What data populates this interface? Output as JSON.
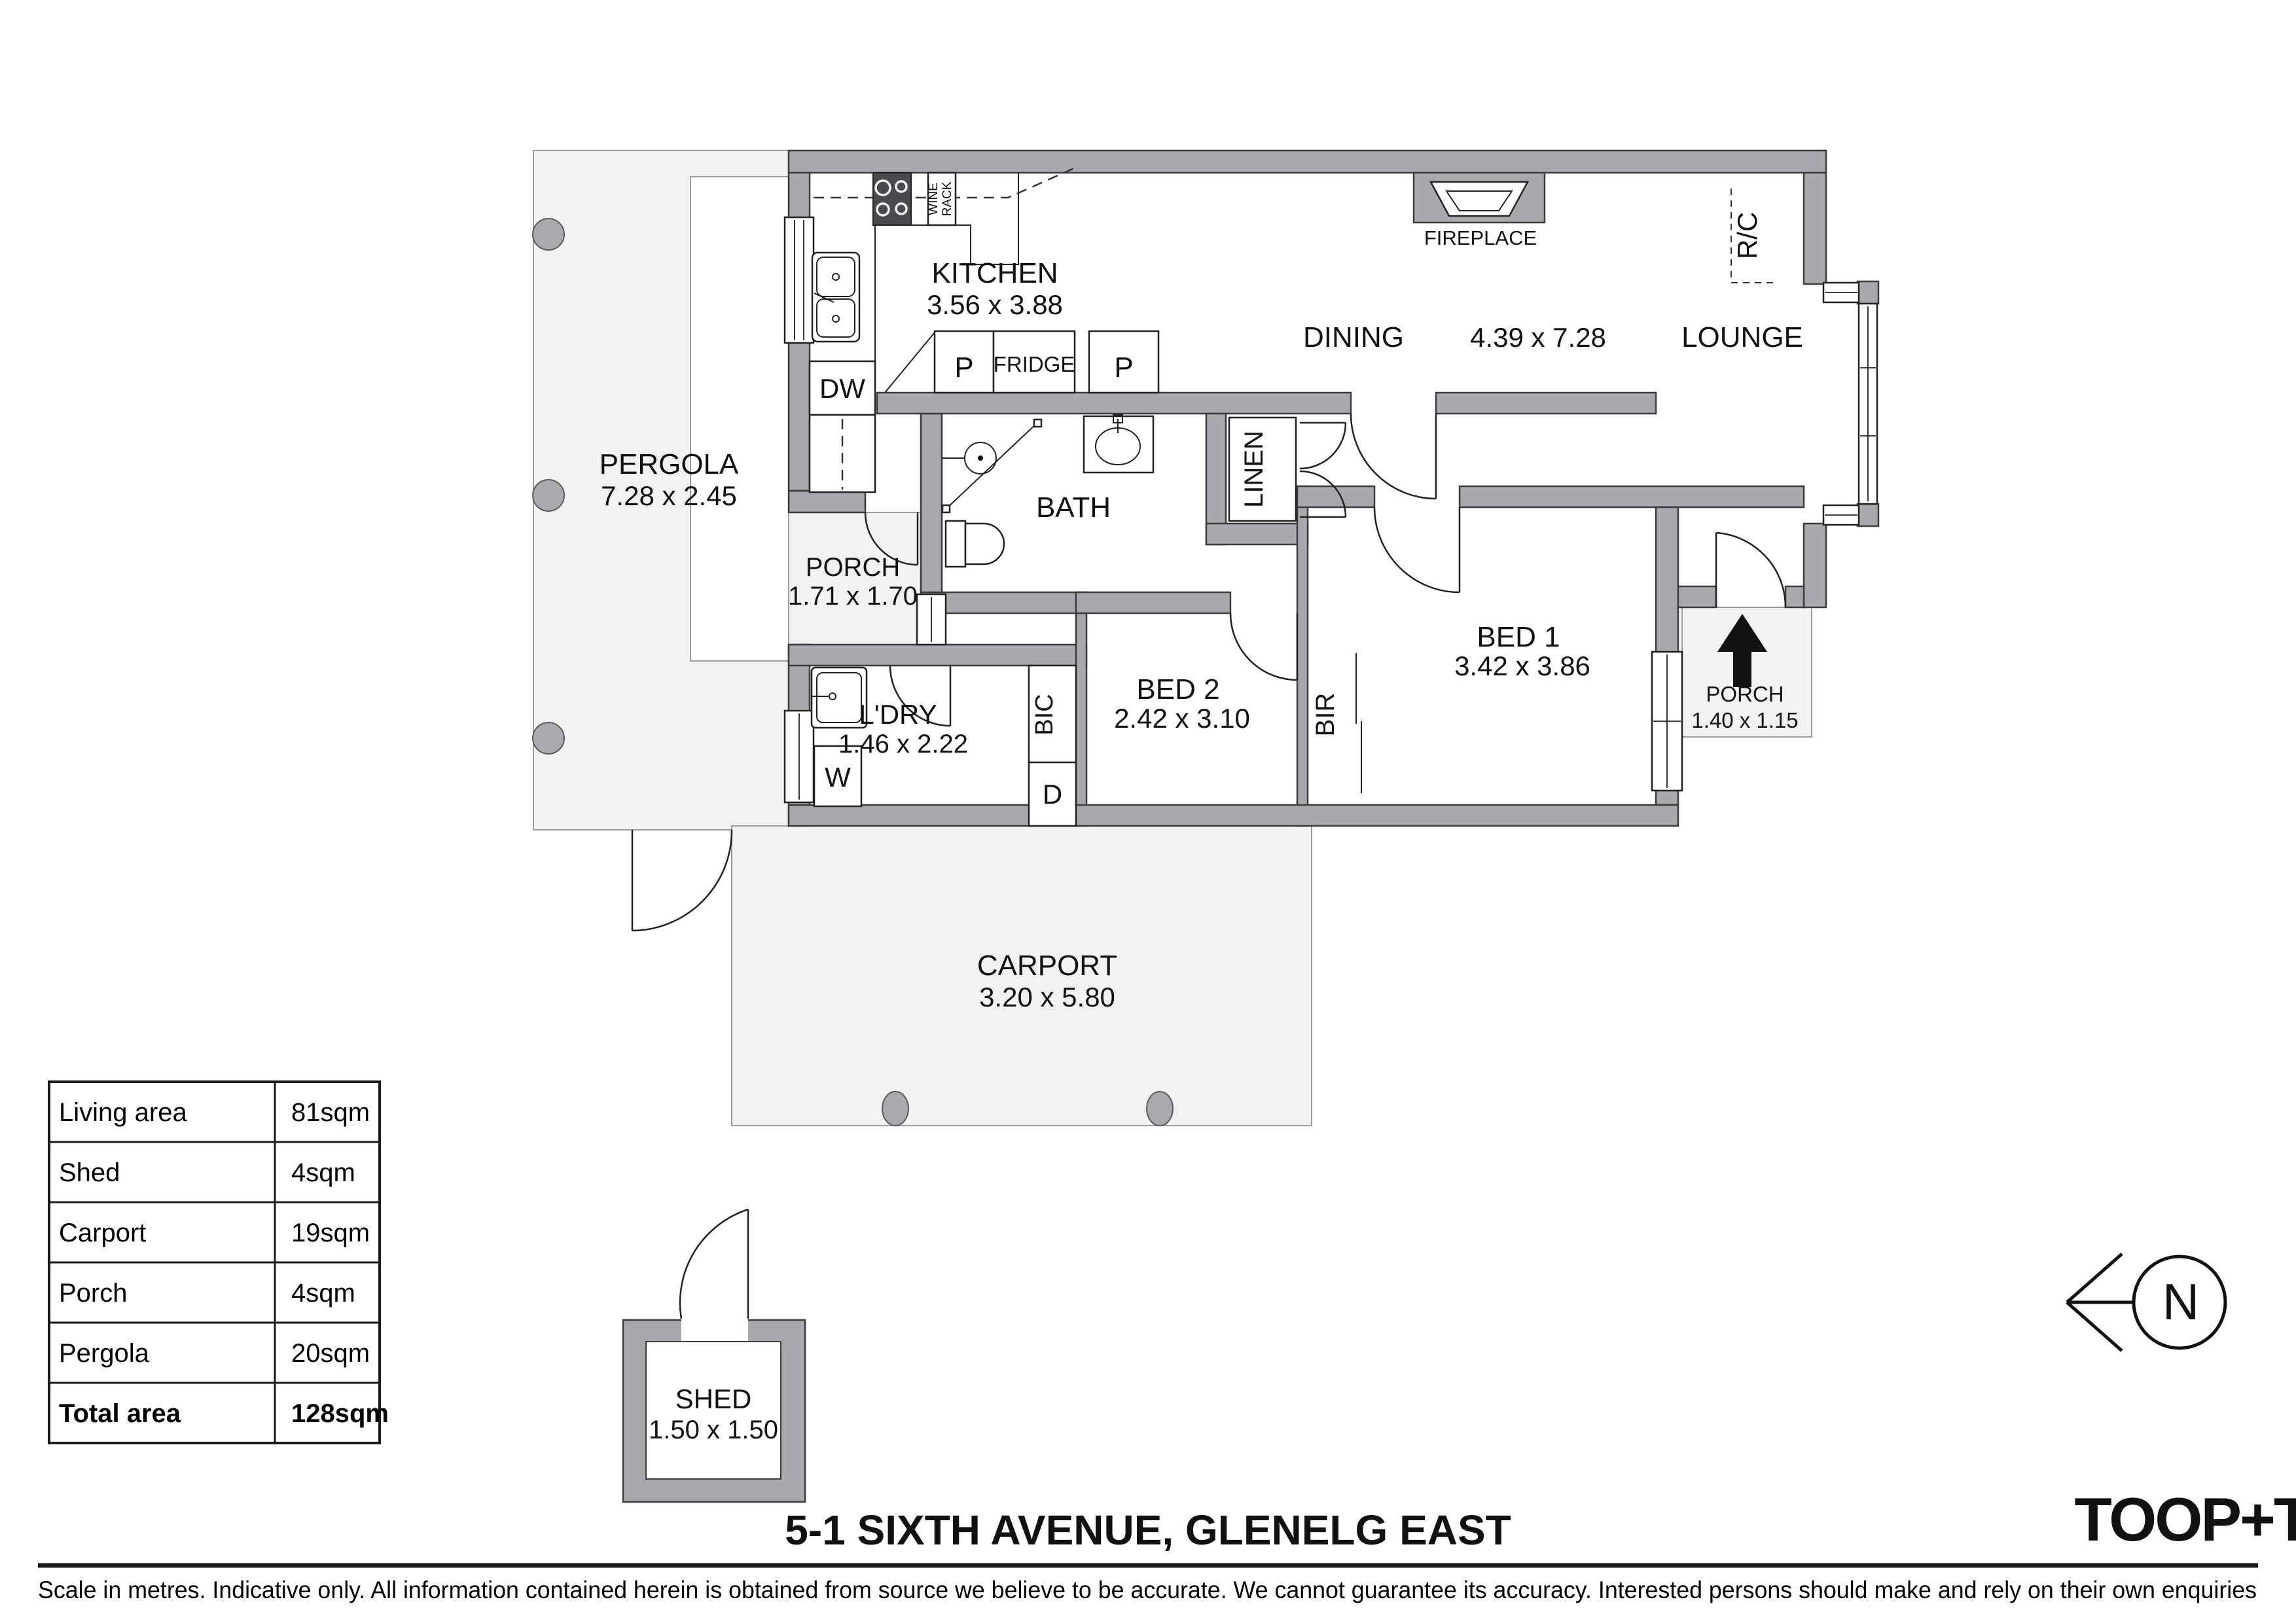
{
  "title": "5-1 SIXTH AVENUE, GLENELG EAST",
  "brand": {
    "logo": "TOOP+TOOP"
  },
  "disclaimer": "Scale in metres. Indicative only. All information contained herein is obtained from source we believe to be accurate. We cannot guarantee its accuracy. Interested persons should make and rely on their own enquiries",
  "north": {
    "label": "N"
  },
  "rooms": {
    "kitchen": {
      "name": "KITCHEN",
      "dims": "3.56 x 3.88"
    },
    "dining": {
      "name": "DINING",
      "dims": "4.39 x 7.28"
    },
    "lounge": {
      "name": "LOUNGE"
    },
    "pergola": {
      "name": "PERGOLA",
      "dims": "7.28 x 2.45"
    },
    "porch_front": {
      "name": "PORCH",
      "dims": "1.71 x 1.70"
    },
    "porch_entry": {
      "name": "PORCH",
      "dims": "1.40 x 1.15"
    },
    "bath": {
      "name": "BATH"
    },
    "bed1": {
      "name": "BED 1",
      "dims": "3.42 x 3.86"
    },
    "bed2": {
      "name": "BED 2",
      "dims": "2.42 x 3.10"
    },
    "laundry": {
      "name": "L'DRY",
      "dims": "1.46 x 2.22"
    },
    "carport": {
      "name": "CARPORT",
      "dims": "3.20 x 5.80"
    },
    "shed": {
      "name": "SHED",
      "dims": "1.50 x 1.50"
    }
  },
  "fixtures": {
    "dishwasher": "DW",
    "washer": "W",
    "dryer": "D",
    "bic": "BIC",
    "bir": "BIR",
    "linen": "LINEN",
    "fridge": "FRIDGE",
    "pantry": "P",
    "wine_line1": "WINE",
    "wine_line2": "RACK",
    "fireplace": "FIREPLACE",
    "rc_unit": "R/C"
  },
  "area_table": {
    "rows": [
      {
        "label": "Living area",
        "value": "81sqm"
      },
      {
        "label": "Shed",
        "value": "4sqm"
      },
      {
        "label": "Carport",
        "value": "19sqm"
      },
      {
        "label": "Porch",
        "value": "4sqm"
      },
      {
        "label": "Pergola",
        "value": "20sqm"
      },
      {
        "label": "Total area",
        "value": "128sqm"
      }
    ]
  },
  "colors": {
    "wall": "#a8a8ad",
    "zone": "#f1f2f2",
    "line": "#3c3c3c",
    "text": "#111111"
  }
}
